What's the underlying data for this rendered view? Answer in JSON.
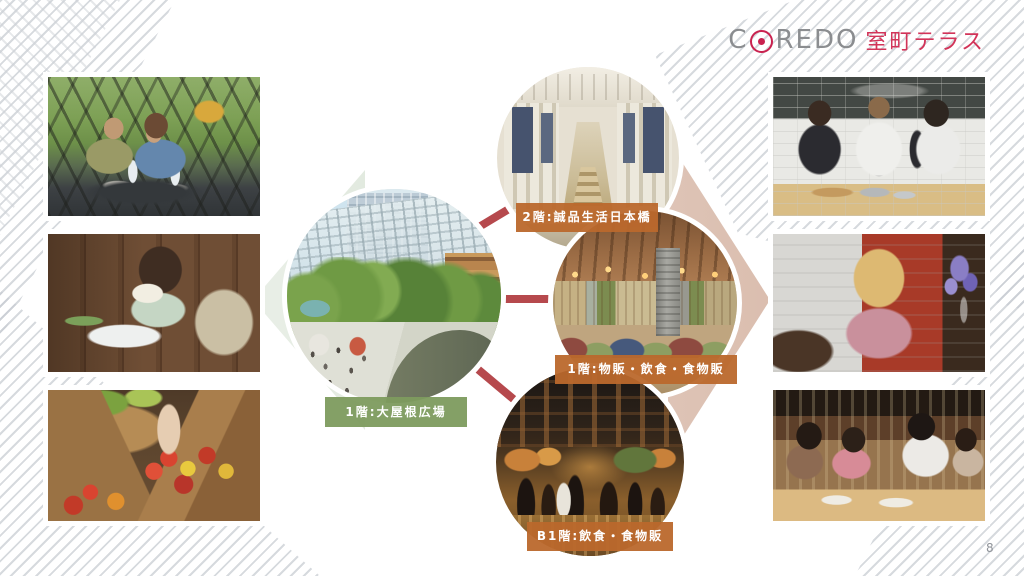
{
  "page": {
    "number": "8"
  },
  "logo": {
    "pre": "C",
    "post": "REDO",
    "jp": "室町テラス",
    "gray_color": "#8b8d90",
    "red_color": "#c9224f",
    "jp_color": "#d23459"
  },
  "diagram": {
    "center": {
      "label": "1階:大屋根広場",
      "bg": "#7d9b5e"
    },
    "nodes": [
      {
        "id": "floor-2",
        "label": "2階:誠品生活日本橋",
        "bg": "#bd6a2f"
      },
      {
        "id": "floor-1",
        "label": "1階:物販・飲食・食物販",
        "bg": "#bd6a2f"
      },
      {
        "id": "floor-b1",
        "label": "B1階:飲食・食物販",
        "bg": "#bd6a2f"
      }
    ],
    "connector_color": "#b6494d",
    "circle_images": [
      "rooftop-plaza-rendering",
      "eslite-bookstore-interior",
      "restaurant-lounge-interior",
      "basement-food-hall"
    ]
  },
  "photos": {
    "left": [
      {
        "name": "terrace-dining-couple"
      },
      {
        "name": "woman-reading-book"
      },
      {
        "name": "vegetable-market"
      }
    ],
    "right": [
      {
        "name": "cooking-class"
      },
      {
        "name": "woman-at-red-wall-cafe"
      },
      {
        "name": "friends-dining-together"
      }
    ]
  }
}
